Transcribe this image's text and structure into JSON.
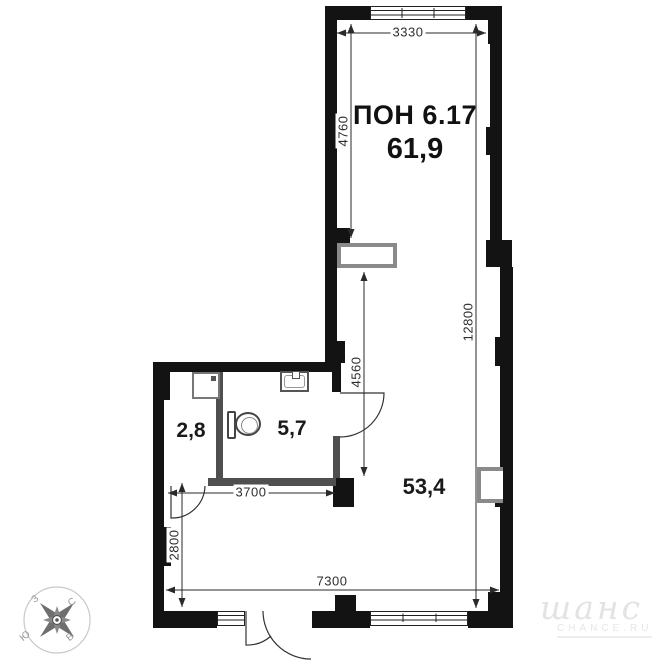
{
  "plan": {
    "unit_label": "ПОН 6.17",
    "total_area": "61,9",
    "rooms": [
      {
        "id": "room-2-8",
        "area": "2,8"
      },
      {
        "id": "room-5-7",
        "area": "5,7"
      },
      {
        "id": "room-53-4",
        "area": "53,4"
      }
    ],
    "dimensions": {
      "top_width": "3330",
      "upper_left_height": "4760",
      "right_height": "12800",
      "middle_height": "4560",
      "bathroom_width": "3700",
      "lower_left_height": "2800",
      "bottom_width": "7300"
    },
    "colors": {
      "wall": "#131313",
      "partition": "#4f4f4f",
      "fixture_outline": "#8a8a8a",
      "dimension_line": "#2a2a2a",
      "watermark": "#e3e3e3"
    }
  },
  "compass": {
    "north": "С",
    "south": "Ю",
    "west": "З",
    "east": "В"
  },
  "watermark": {
    "logo": "шанс",
    "domain": "CHANCE.RU"
  }
}
